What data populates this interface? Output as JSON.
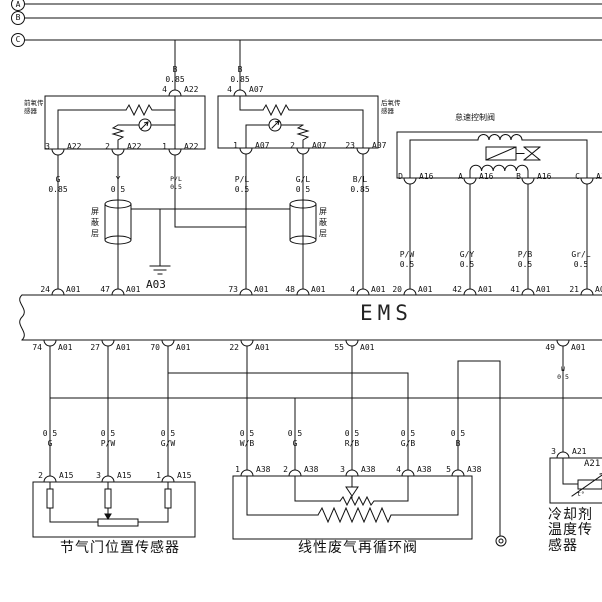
{
  "buses": {
    "a": "A",
    "b": "B",
    "c": "C"
  },
  "o2_front": {
    "label1": "前氧传",
    "label2": "感器",
    "feed_color": "B",
    "feed_size": "0.85",
    "pin_top": {
      "n": "4",
      "c": "A22"
    },
    "pin3": {
      "n": "3",
      "c": "A22"
    },
    "pin2": {
      "n": "2",
      "c": "A22"
    },
    "pin1": {
      "n": "1",
      "c": "A22"
    }
  },
  "o2_rear": {
    "label1": "后氧传",
    "label2": "感器",
    "feed_color": "B",
    "feed_size": "0.85",
    "pin_top": {
      "n": "4",
      "c": "A07"
    },
    "pin1": {
      "n": "1",
      "c": "A07"
    },
    "pin2": {
      "n": "2",
      "c": "A07"
    },
    "pin23": {
      "n": "23",
      "c": "A07"
    }
  },
  "iacv": {
    "label": "怠速控制阀",
    "pinD": {
      "n": "D",
      "c": "A16"
    },
    "pinA": {
      "n": "A",
      "c": "A16"
    },
    "pinB": {
      "n": "B",
      "c": "A16"
    },
    "pinC": {
      "n": "C",
      "c": "A16"
    }
  },
  "shield": {
    "left": "屏蔽层",
    "right": "屏蔽层"
  },
  "ground_a03": "A03",
  "wires_upper": {
    "g": {
      "color": "G",
      "size": "0.85"
    },
    "y": {
      "color": "Y",
      "size": "0.5"
    },
    "pl1": {
      "color": "P/L",
      "size": "0.5"
    },
    "pl2": {
      "color": "P/L",
      "size": "0.5"
    },
    "gl": {
      "color": "G/L",
      "size": "0.5"
    },
    "bl": {
      "color": "B/L",
      "size": "0.85"
    },
    "pw": {
      "color": "P/W",
      "size": "0.5"
    },
    "gy": {
      "color": "G/Y",
      "size": "0.5"
    },
    "pb": {
      "color": "P/B",
      "size": "0.5"
    },
    "grl": {
      "color": "Gr/L",
      "size": "0.5"
    }
  },
  "ems": {
    "title": "EMS",
    "top_pins": [
      {
        "n": "24",
        "c": "A01"
      },
      {
        "n": "47",
        "c": "A01"
      },
      {
        "n": "73",
        "c": "A01"
      },
      {
        "n": "48",
        "c": "A01"
      },
      {
        "n": "4",
        "c": "A01"
      },
      {
        "n": "20",
        "c": "A01"
      },
      {
        "n": "42",
        "c": "A01"
      },
      {
        "n": "41",
        "c": "A01"
      },
      {
        "n": "21",
        "c": "A01"
      }
    ],
    "bottom_pins": [
      {
        "n": "74",
        "c": "A01"
      },
      {
        "n": "27",
        "c": "A01"
      },
      {
        "n": "70",
        "c": "A01"
      },
      {
        "n": "22",
        "c": "A01"
      },
      {
        "n": "55",
        "c": "A01"
      },
      {
        "n": "49",
        "c": "A01"
      }
    ]
  },
  "wires_lower": [
    {
      "size": "0.5",
      "color": "G"
    },
    {
      "size": "0.5",
      "color": "P/W"
    },
    {
      "size": "0.5",
      "color": "G/W"
    },
    {
      "size": "0.5",
      "color": "W/B"
    },
    {
      "size": "0.5",
      "color": "G"
    },
    {
      "size": "0.5",
      "color": "R/B"
    },
    {
      "size": "0.5",
      "color": "G/B"
    },
    {
      "size": "0.5",
      "color": "B"
    }
  ],
  "wire_w": {
    "color": "W",
    "size": "0.5"
  },
  "tps": {
    "label": "节气门位置传感器",
    "pin2": {
      "n": "2",
      "c": "A15"
    },
    "pin3": {
      "n": "3",
      "c": "A15"
    },
    "pin1": {
      "n": "1",
      "c": "A15"
    }
  },
  "egr": {
    "label": "线性废气再循环阀",
    "pins": [
      {
        "n": "1",
        "c": "A38"
      },
      {
        "n": "2",
        "c": "A38"
      },
      {
        "n": "3",
        "c": "A38"
      },
      {
        "n": "4",
        "c": "A38"
      },
      {
        "n": "5",
        "c": "A38"
      }
    ]
  },
  "ect": {
    "label": "冷却剂温度传感器",
    "pin3": {
      "n": "3",
      "c": "A21"
    },
    "inner": "A21",
    "thermo": "t°"
  }
}
